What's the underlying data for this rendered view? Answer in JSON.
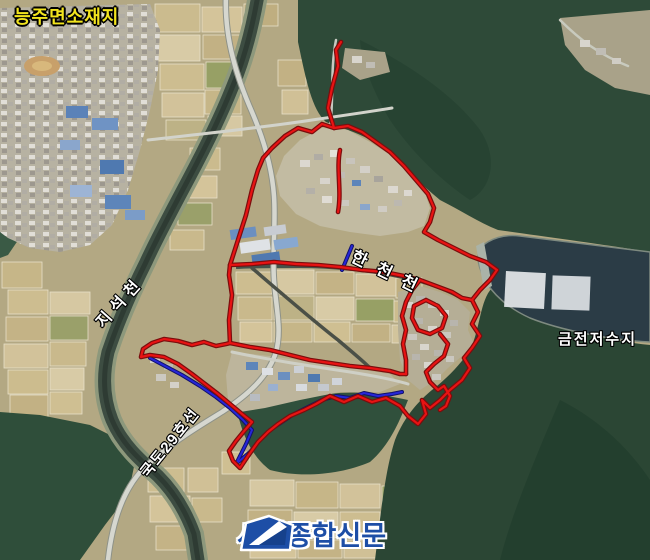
{
  "map": {
    "type": "satellite-aerial-photo",
    "labels": {
      "town": {
        "text": "능주면소재지",
        "color": "#f2e41e"
      },
      "river_left": {
        "text": "지석천",
        "color": "#ffffff"
      },
      "stream_center": {
        "text": "한천천",
        "color": "#ffffff"
      },
      "reservoir": {
        "text": "금전저수지",
        "color": "#ffffff"
      },
      "road": {
        "text": "국도29호선",
        "color": "#ffffff"
      }
    },
    "overlay_colors": {
      "district_boundary_red": "#e01212",
      "project_line_blue": "#2424cc"
    },
    "terrain_colors": {
      "forest": "#2e4a38",
      "field": "#c9b98c",
      "water": "#2b3c46",
      "road": "#d6d7cf"
    }
  },
  "watermark": {
    "publisher": "시사종합신문",
    "logo_color": "#1d4ea6"
  }
}
